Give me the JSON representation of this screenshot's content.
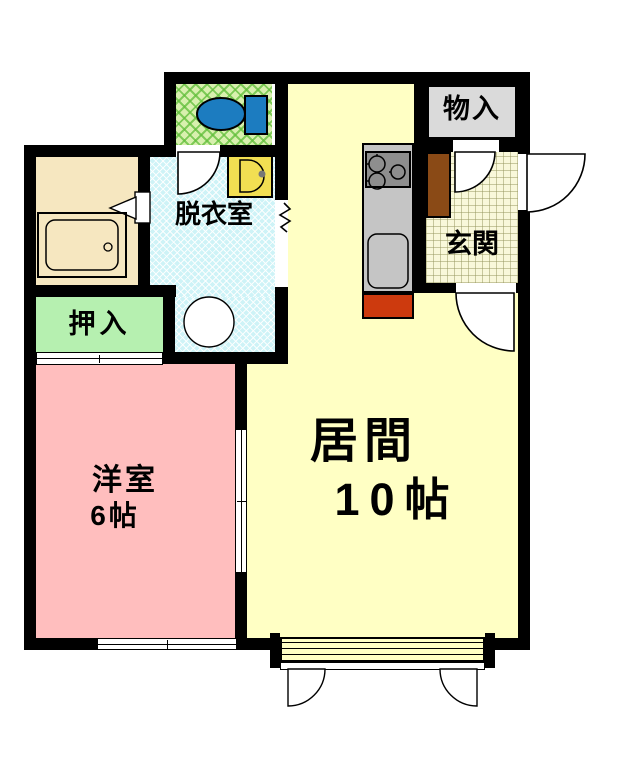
{
  "rooms": {
    "living": {
      "label": "居間",
      "size": "10帖"
    },
    "western": {
      "label": "洋室",
      "size": "6帖"
    },
    "dressing": {
      "label": "脱衣室"
    },
    "entrance": {
      "label": "玄関"
    },
    "storage": {
      "label": "物入"
    },
    "closet": {
      "label": "押入"
    }
  },
  "fixtures": [
    "toilet-icon",
    "bathtub-icon",
    "washing-machine-icon",
    "wash-basin-icon",
    "stove-burners-icon",
    "kitchen-sink-icon",
    "shoe-cabinet-icon",
    "appliance-space-icon",
    "door-swing-icon",
    "folding-door-icon",
    "sliding-door-icon",
    "sliding-window-icon",
    "wall-opening-squiggle-icon",
    "balcony-step-icon"
  ],
  "colors": {
    "wall": "#000000",
    "living": "#ffffc4",
    "western": "#ffbebe",
    "closet": "#b6f0b0",
    "toiletRoom": "#d8f0ae",
    "dressing": "#cef3f7",
    "bathroom": "#f6e7c0",
    "entrance": "#f9f8da",
    "storage": "#dadada",
    "counter": "#c5c5c5",
    "stove": "#8e8e8e",
    "applianceRed": "#cd3a0e",
    "shoeCabinet": "#8a4a16",
    "toiletFixture": "#1c7cc0",
    "basin": "#f2df52"
  }
}
